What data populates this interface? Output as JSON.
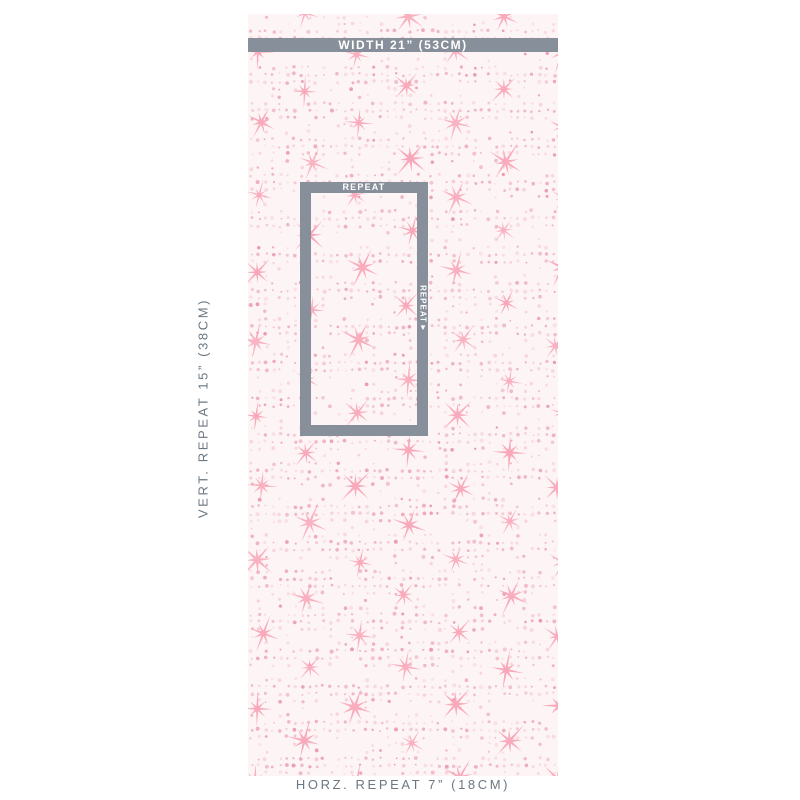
{
  "colors": {
    "page_background": "#ffffff",
    "measure_gray": "#878f9a",
    "measure_text": "#ffffff",
    "annotation_text": "#6b7781",
    "swatch_background": "#fdf4f5",
    "star_pink": "#f8a5b7",
    "dot_pink": "#eeafbf",
    "dot_pink_light": "#f7d3dc",
    "dot_pink_dark": "#e99cb1"
  },
  "swatch": {
    "description": "white wallpaper swatch with pink spark stars and halftone dot bands",
    "width_bar": {
      "label": "WIDTH 21” (53CM)"
    },
    "repeat_box": {
      "top_label": "REPEAT",
      "side_label": "REPEAT▼"
    }
  },
  "annotations": {
    "vertical_repeat": "VERT. REPEAT 15” (38CM)",
    "horizontal_repeat": "HORZ. REPEAT 7” (18CM)"
  }
}
